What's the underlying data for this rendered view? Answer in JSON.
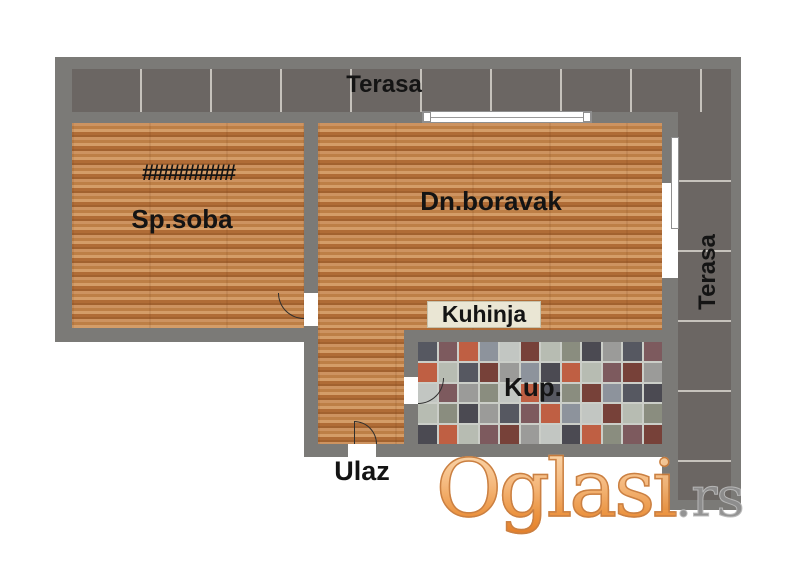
{
  "rooms": {
    "terrace_top": "Terasa",
    "terrace_right": "Terasa",
    "bedroom": "Sp.soba",
    "bedroom_radiator": "#########",
    "living_room": "Dn.boravak",
    "kitchen": "Kuhinja",
    "bathroom": "Kup.",
    "entrance": "Ulaz"
  },
  "watermark": {
    "brand": "Oglasi",
    "tld": ".rs"
  },
  "colors": {
    "wall": "#7b7a77",
    "wood_floor": "#c2854e",
    "terrace_tile": "#6b6663",
    "label_text": "#141414",
    "kitchen_label_bg": "#eae6d4",
    "watermark_orange": "#e2771e",
    "watermark_gray": "#8f8f8f",
    "bathroom_tiles": [
      "#565861",
      "#8d939c",
      "#b7bcb2",
      "#9b9b99",
      "#bf5f43",
      "#774139",
      "#4b4a52",
      "#7d5a5e",
      "#c2c6c2",
      "#8a8d7f"
    ]
  }
}
